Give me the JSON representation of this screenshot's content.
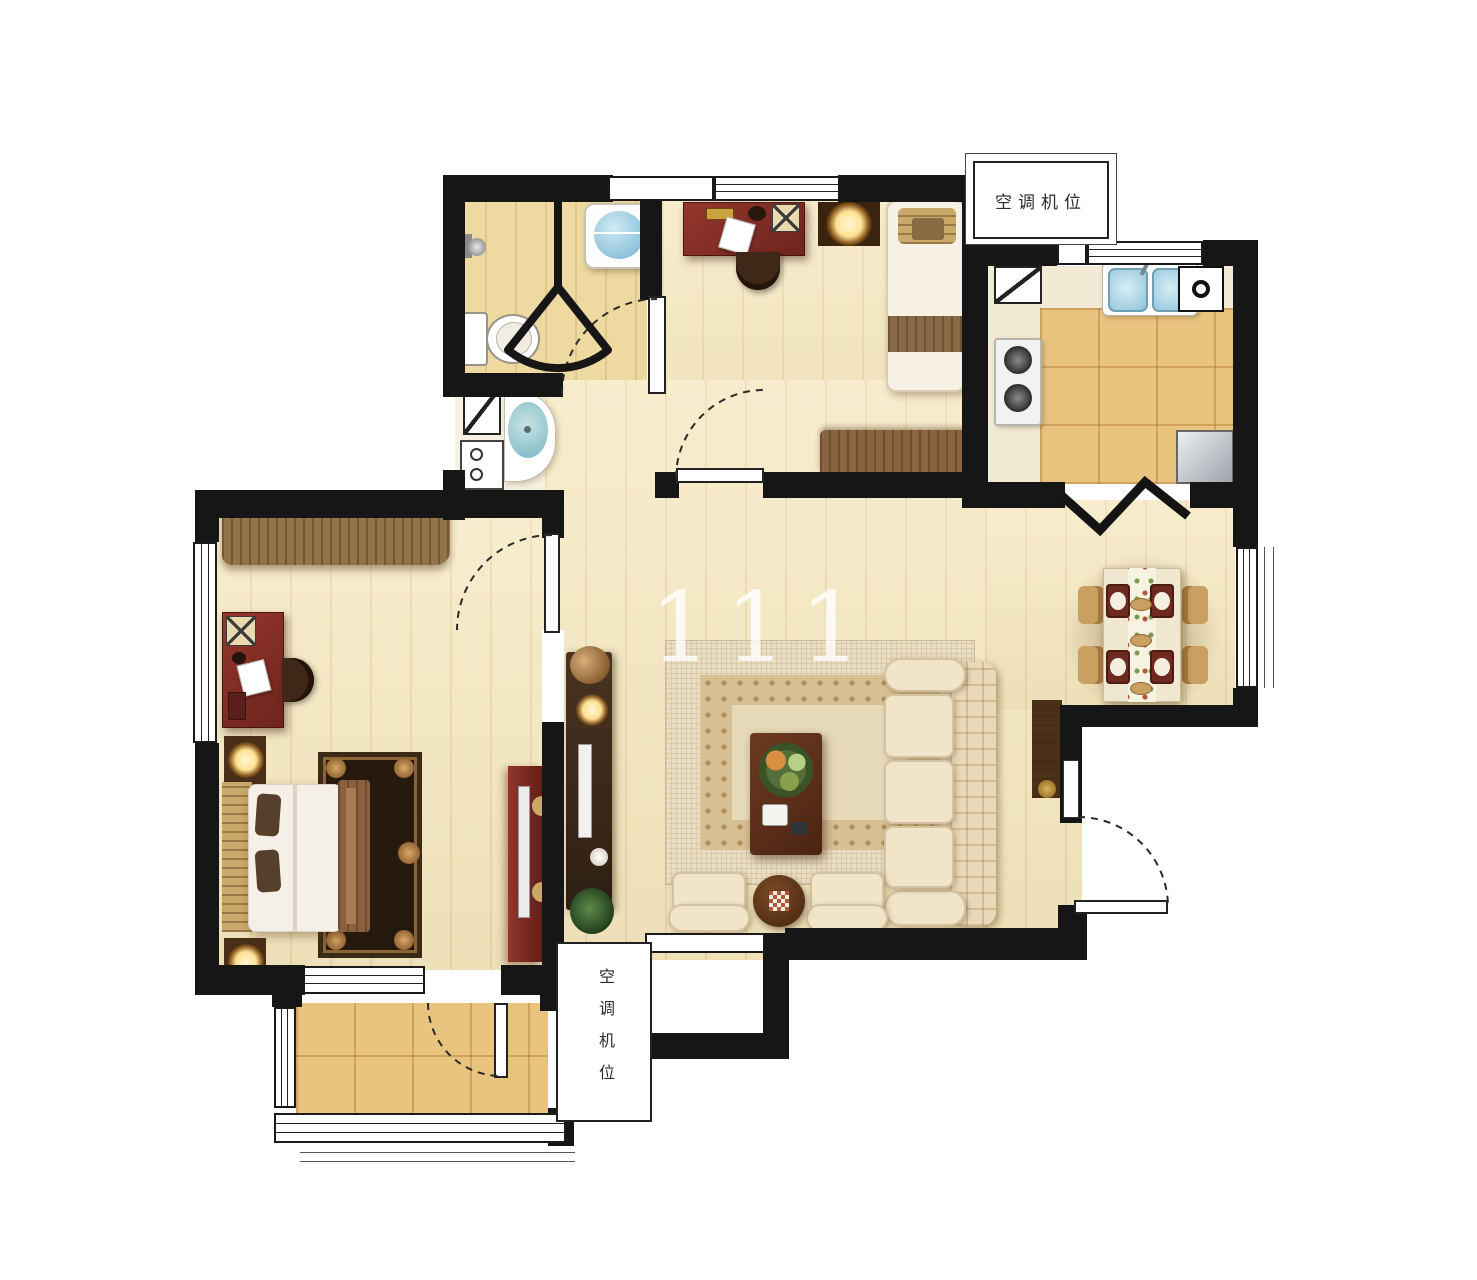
{
  "watermark": "111",
  "labels": {
    "ac_top": "空调机位",
    "ac_bottom": "空调机位"
  },
  "colors": {
    "wall": "#161616",
    "wood": "#f5e7bd",
    "wood_line": "rgba(190,150,80,0.18)",
    "tile": "#e9c47f",
    "tile_line": "rgba(170,110,45,0.4)",
    "bath_floor": "#eed9a0",
    "vanity_floor": "#f7f1e1",
    "mahogany": "#7d2b24",
    "dark_wood": "#4a2f18",
    "mid_wood": "#8a6542",
    "tan": "#c9a869",
    "cream": "#f1e5c9",
    "rug_outer": "#e9ddc2",
    "rug_band": "#d7c094",
    "bed_rug": "#261a0f",
    "sink_blue": "#9fd0e2",
    "glow_core": "#fff6d0"
  }
}
